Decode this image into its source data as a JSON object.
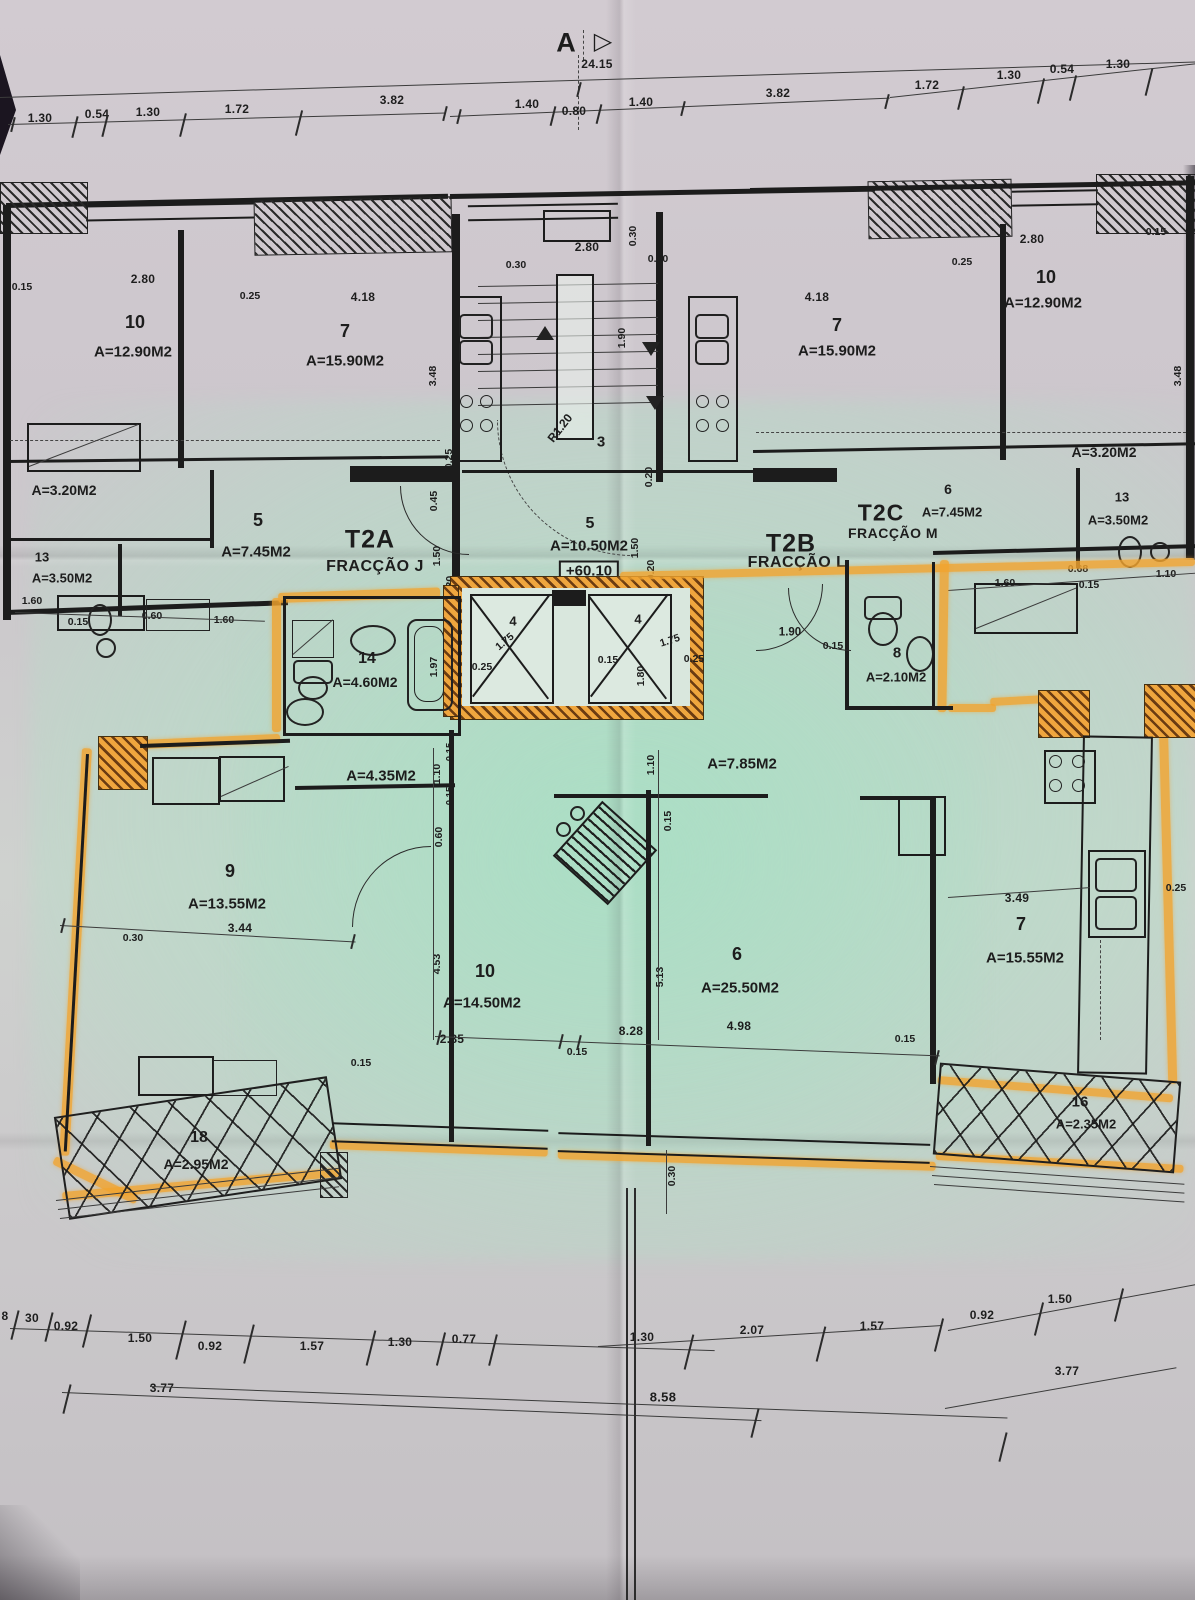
{
  "photo_subject": "architectural floor plan photograph with one apartment highlighted in orange marker",
  "colors": {
    "highlighter": "#f2a42e",
    "paper": "#cbc5cb",
    "green_tint": "#cfe3d8",
    "ink": "#1c1c1c"
  },
  "section_marker": {
    "letter": "A",
    "arrow": "▷",
    "overall_dim": "24.15"
  },
  "fractions": {
    "t2a": {
      "code": "T2A",
      "name": "FRACÇÃO J"
    },
    "t2b": {
      "code": "T2B",
      "name": "FRACÇÃO L"
    },
    "t2c": {
      "code": "T2C",
      "name": "FRACÇÃO M"
    }
  },
  "dim_rows": {
    "top_left": [
      "1.30",
      "0.54",
      "1.30",
      "1.72",
      "3.82"
    ],
    "top_center": [
      "1.40",
      "0.80",
      "1.40",
      "3.82"
    ],
    "top_right": [
      "1.72",
      "1.30",
      "0.54",
      "1.30"
    ],
    "bottom_upper": [
      "8",
      "30",
      "0.92",
      "1.50",
      "0.92",
      "1.57",
      "1.30",
      "0.77",
      "1.30",
      "2.07",
      "1.57",
      "0.92",
      "1.50"
    ],
    "bottom_lower": [
      "3.77",
      "8.58",
      "3.77"
    ]
  },
  "upper_left_apt": {
    "room10": {
      "num": "10",
      "area": "A=12.90M2"
    },
    "room7": {
      "num": "7",
      "area": "A=15.90M2"
    },
    "room5": {
      "num": "5",
      "area": "A=7.45M2"
    },
    "room13": {
      "num": "13",
      "area": "A=3.50M2"
    },
    "storage_area": "A=3.20M2",
    "dims": [
      "0.15",
      "2.80",
      "0.25",
      "4.18",
      "3.48",
      "1.60",
      "0.15",
      "0.60",
      "1.60"
    ]
  },
  "upper_right_apt": {
    "room7": {
      "num": "7",
      "area": "A=15.90M2"
    },
    "room10": {
      "num": "10",
      "area": "A=12.90M2"
    },
    "room6": {
      "num": "6",
      "area": "A=7.45M2"
    },
    "room13": {
      "num": "13",
      "area": "A=3.50M2"
    },
    "storage_area": "A=3.20M2",
    "dims": [
      "4.18",
      "0.25",
      "2.80",
      "0.15",
      "3.48",
      "1.60",
      "0.68",
      "0.15",
      "1.10"
    ]
  },
  "stair_core": {
    "stair_room": "3",
    "radius_label": "R1.20",
    "hall5": {
      "num": "5",
      "area": "A=10.50M2",
      "level": "+60.10"
    },
    "dims": [
      "2.80",
      "0.30",
      "0.30",
      "0.30",
      "1.90",
      "0.20",
      "0.25",
      "0.45",
      "1.50",
      "0.30",
      "1.50",
      "0.20"
    ],
    "lifts": {
      "left_num": "4",
      "left_w": "1.75",
      "right_num": "4",
      "right_w": "1.75",
      "dims": [
        "0.25",
        "0.15",
        "1.80",
        "0.25",
        "1.97"
      ]
    }
  },
  "apartment": {
    "bath14": {
      "num": "14",
      "area": "A=4.60M2"
    },
    "wc8": {
      "num": "8",
      "area": "A=2.10M2"
    },
    "hall_a": "A=4.35M2",
    "hall_b": "A=7.85M2",
    "room9": {
      "num": "9",
      "area": "A=13.55M2"
    },
    "room10": {
      "num": "10",
      "area": "A=14.50M2"
    },
    "room6": {
      "num": "6",
      "area": "A=25.50M2"
    },
    "room7": {
      "num": "7",
      "area": "A=15.55M2"
    },
    "balcony18": {
      "num": "18",
      "area": "A=2.95M2"
    },
    "balcony16": {
      "num": "16",
      "area": "A=2.35M2"
    },
    "dims": [
      "1.10",
      "0.15",
      "0.15",
      "0.60",
      "3.44",
      "0.30",
      "1.10",
      "0.15",
      "4.53",
      "5.13",
      "2.85",
      "0.15",
      "8.28",
      "4.98",
      "0.15",
      "3.49",
      "0.25",
      "1.90",
      "0.15",
      "0.15",
      "0.30"
    ]
  }
}
